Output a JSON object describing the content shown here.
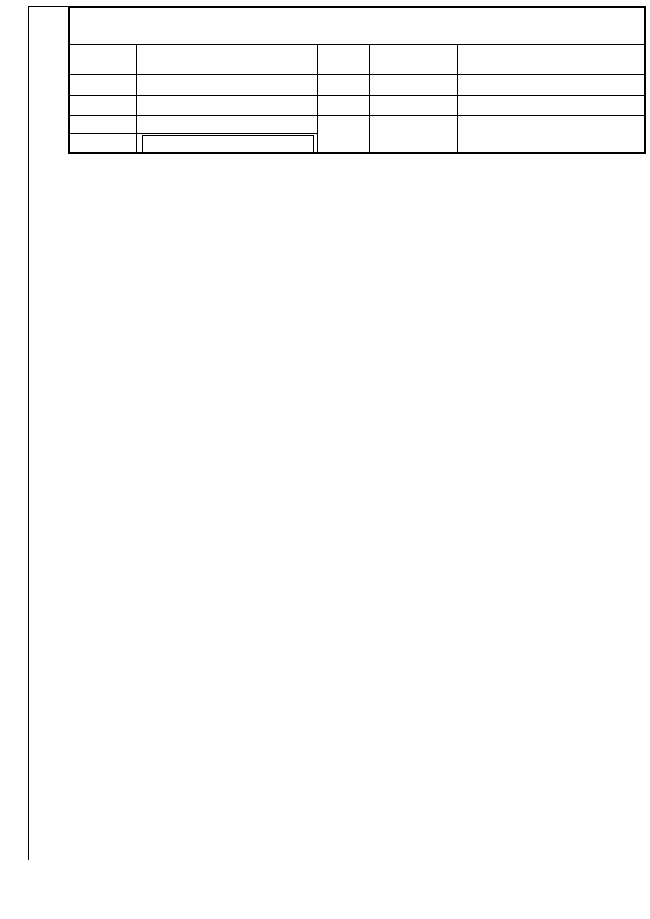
{
  "title_block": {
    "title": "GEODETSKI NAČRT",
    "rows": [
      {
        "label": "KATASTRSKA OBČINA",
        "value": "1246 - DEKMANCA"
      },
      {
        "label": "ŠT.VLOGE",
        "value": "27ŠM08"
      },
      {
        "label": "MERILO",
        "value": "1 : 500"
      },
      {
        "label": "PARCELA",
        "value": "280/3, *41"
      },
      {
        "label": "OPOMBA",
        "value": ""
      }
    ],
    "opomba_lines": [
      "PARCELNE MEJE: VIR/KAT.NAČRT 1:2880",
      "GK KOORD.SISTEM, VIŠINE SO ABSOLUTNE"
    ],
    "right": {
      "header_date": "Dne",
      "header_name": "Ime in priimek",
      "rows": [
        {
          "role": "Naročnik",
          "date": "22.6.2008",
          "name": "Vračun Ivan, Dekmanca 15"
        },
        {
          "role": "Meritve izvedel",
          "date": "7.7.2008",
          "name": "Matej Vračun dipl. inž.geod."
        },
        {
          "role": "Potrdil",
          "date": "4.8.2008",
          "name": "Matej Kovačič univ.dipl.inž.geod."
        }
      ]
    }
  },
  "frame": {
    "northings": [
      {
        "lines": [
          "104",
          "350"
        ],
        "y": 96
      },
      {
        "lines": [
          "104",
          "300"
        ],
        "y": 413
      },
      {
        "lines": [
          "104",
          "250"
        ],
        "y": 722
      },
      {
        "lines": [
          "104",
          "225"
        ],
        "y": 874
      }
    ],
    "eastings": [
      {
        "lines": [
          "548",
          "950"
        ],
        "x": 27
      },
      {
        "lines": [
          "549",
          "000"
        ],
        "x": 303
      },
      {
        "lines": [
          "549",
          "050"
        ],
        "x": 582
      }
    ],
    "credit": "Geodetski zavod Celje d.o.o.",
    "geos": "®GEOS 6"
  },
  "legend": {
    "title": "LEGENDA",
    "items": [
      {
        "sym": "drog",
        "label": "- Drog za električni vod nizke napetosti",
        "y": 671
      },
      {
        "sym": "jasek",
        "label": "- Kvadratni jašek",
        "y": 687
      },
      {
        "sym": "tel",
        "label": "- Telefonska omarica",
        "y": 700
      },
      {
        "sym": "stavba",
        "label": "- Stanovanjska stavba",
        "y": 712
      },
      {
        "sym": "gospodarsko",
        "label": "- Gospodarsko poslopje",
        "y": 726
      },
      {
        "sym": "vrt",
        "label": "- Vrt",
        "y": 739
      },
      {
        "sym": "travnik",
        "label": "- Travnik",
        "y": 751
      },
      {
        "sym": "znak",
        "label": "- znak pripadnosti",
        "y": 772
      },
      {
        "sym": "sevar",
        "label": "- Sevar",
        "y": 785
      },
      {
        "sym": "ograja",
        "label": "- Ograja",
        "y": 797
      },
      {
        "sym": "vodovod",
        "label": "- Vodovod",
        "y": 810
      },
      {
        "sym": "elvod",
        "label": "- El.vod N.N.",
        "y": 823
      },
      {
        "sym": "ptt",
        "label": "- PTT vod",
        "y": 836
      },
      {
        "sym": "meja",
        "label": "- Parcelna meja",
        "y": 855
      },
      {
        "sym": "stevilka",
        "label": "- Parcelna številka",
        "y": 884
      }
    ],
    "parcel_sample": "280/3"
  },
  "map": {
    "colors": {
      "parcel": "#ff00e6",
      "parcel_pale": "#ffa8ef",
      "contour": "#b06a28",
      "water": "#2233dd",
      "power": "#cc2211",
      "ptt": "#e08a00",
      "black": "#000000"
    },
    "parcel_labels": [
      {
        "t": "281/1",
        "x": 172,
        "y": 380
      },
      {
        "t": "281/2",
        "x": 375,
        "y": 395
      },
      {
        "t": "185",
        "x": 591,
        "y": 233
      },
      {
        "t": "280/1",
        "x": 589,
        "y": 337
      },
      {
        "t": "280/2",
        "x": 556,
        "y": 530
      },
      {
        "t": "280/3",
        "x": 283,
        "y": 582
      },
      {
        "t": "*41",
        "x": 321,
        "y": 509
      },
      {
        "t": "*42/1",
        "x": 219,
        "y": 581
      },
      {
        "t": "*42/2",
        "x": 141,
        "y": 730
      },
      {
        "t": "*42/3",
        "x": 286,
        "y": 659
      },
      {
        "t": "280/4",
        "x": 279,
        "y": 721
      },
      {
        "t": "1440",
        "x": 552,
        "y": 601
      },
      {
        "t": "1443",
        "x": 422,
        "y": 667
      }
    ],
    "contour_labels": [
      {
        "t": "210",
        "x": 506,
        "y": 222,
        "rot": -38
      },
      {
        "t": "209",
        "x": 441,
        "y": 343,
        "rot": -50
      },
      {
        "t": "215",
        "x": 237,
        "y": 414,
        "rot": -18
      }
    ],
    "spot_heights": [
      {
        "x": 333,
        "y": 204,
        "v": "208.86"
      },
      {
        "x": 321,
        "y": 212,
        "v": "208.88"
      },
      {
        "x": 404,
        "y": 195,
        "v": "205.95"
      },
      {
        "x": 414,
        "y": 255,
        "v": "206.37"
      },
      {
        "x": 309,
        "y": 241,
        "v": "211.15"
      },
      {
        "x": 604,
        "y": 247,
        "v": "203.96"
      },
      {
        "x": 634,
        "y": 271,
        "v": "204.42"
      },
      {
        "x": 552,
        "y": 289,
        "v": "205.05"
      },
      {
        "x": 616,
        "y": 339,
        "v": "205.93"
      },
      {
        "x": 587,
        "y": 372,
        "v": "206.79"
      },
      {
        "x": 540,
        "y": 409,
        "v": "211.48"
      },
      {
        "x": 437,
        "y": 318,
        "v": "205.20"
      },
      {
        "x": 196,
        "y": 293,
        "v": "212.22"
      },
      {
        "x": 341,
        "y": 305,
        "v": "211.81"
      },
      {
        "x": 351,
        "y": 336,
        "v": "212.71"
      },
      {
        "x": 256,
        "y": 370,
        "v": "212.72"
      },
      {
        "x": 270,
        "y": 374,
        "v": "212.27"
      },
      {
        "x": 313,
        "y": 384,
        "v": "214.58"
      },
      {
        "x": 232,
        "y": 400,
        "v": "216.20"
      },
      {
        "x": 98,
        "y": 359,
        "v": "212.93"
      },
      {
        "x": 497,
        "y": 345,
        "v": "209.28"
      },
      {
        "x": 452,
        "y": 380,
        "v": "211.02"
      },
      {
        "x": 500,
        "y": 392,
        "v": "211.99"
      },
      {
        "x": 223,
        "y": 425,
        "v": "215.12"
      },
      {
        "x": 233,
        "y": 438,
        "v": "215.75"
      },
      {
        "x": 272,
        "y": 440,
        "v": "215.77"
      },
      {
        "x": 330,
        "y": 425,
        "v": "215.13"
      },
      {
        "x": 327,
        "y": 442,
        "v": "215.43"
      },
      {
        "x": 345,
        "y": 462,
        "v": "216.75"
      },
      {
        "x": 273,
        "y": 477,
        "v": "216.18"
      },
      {
        "x": 255,
        "y": 498,
        "v": "215.80"
      },
      {
        "x": 265,
        "y": 515,
        "v": "215.90"
      },
      {
        "x": 193,
        "y": 537,
        "v": "217.43"
      },
      {
        "x": 103,
        "y": 573,
        "v": "215.57"
      },
      {
        "x": 132,
        "y": 583,
        "v": "217.75"
      },
      {
        "x": 213,
        "y": 568,
        "v": "217.73"
      },
      {
        "x": 243,
        "y": 592,
        "v": "217.14"
      },
      {
        "x": 175,
        "y": 605,
        "v": "217.80"
      },
      {
        "x": 203,
        "y": 628,
        "v": "217.82"
      },
      {
        "x": 153,
        "y": 622,
        "v": "218.00"
      },
      {
        "x": 173,
        "y": 652,
        "v": "215.24"
      },
      {
        "x": 168,
        "y": 672,
        "v": "215.20"
      },
      {
        "x": 263,
        "y": 608,
        "v": "215.83"
      },
      {
        "x": 290,
        "y": 638,
        "v": "215.87"
      },
      {
        "x": 317,
        "y": 658,
        "v": "215.90"
      },
      {
        "x": 352,
        "y": 535,
        "v": "216.43"
      },
      {
        "x": 325,
        "y": 560,
        "v": "215.42"
      },
      {
        "x": 307,
        "y": 568,
        "v": "216.88"
      },
      {
        "x": 317,
        "y": 592,
        "v": "215.24"
      },
      {
        "x": 312,
        "y": 597,
        "v": "215.22"
      },
      {
        "x": 323,
        "y": 598,
        "v": "215.47"
      },
      {
        "x": 138,
        "y": 455,
        "v": "214.59"
      },
      {
        "x": 425,
        "y": 412,
        "v": "212.82"
      },
      {
        "x": 402,
        "y": 442,
        "v": "216.44"
      },
      {
        "x": 442,
        "y": 445,
        "v": "214.89"
      },
      {
        "x": 475,
        "y": 442,
        "v": "211.98"
      },
      {
        "x": 522,
        "y": 423,
        "v": "213.04"
      },
      {
        "x": 478,
        "y": 468,
        "v": "211.95"
      },
      {
        "x": 430,
        "y": 462,
        "v": "214.08"
      },
      {
        "x": 448,
        "y": 475,
        "v": "211.25"
      },
      {
        "x": 390,
        "y": 470,
        "v": "214.13"
      },
      {
        "x": 430,
        "y": 488,
        "v": "213.82"
      },
      {
        "x": 415,
        "y": 498,
        "v": "211.39"
      },
      {
        "x": 462,
        "y": 503,
        "v": "211.27"
      },
      {
        "x": 422,
        "y": 515,
        "v": "212.12"
      },
      {
        "x": 448,
        "y": 532,
        "v": "210.85"
      },
      {
        "x": 455,
        "y": 542,
        "v": "210.83"
      },
      {
        "x": 455,
        "y": 552,
        "v": "210.87"
      },
      {
        "x": 432,
        "y": 560,
        "v": "211.07"
      },
      {
        "x": 437,
        "y": 573,
        "v": "212.97"
      },
      {
        "x": 440,
        "y": 587,
        "v": "213.25"
      },
      {
        "x": 470,
        "y": 572,
        "v": "210.41"
      },
      {
        "x": 520,
        "y": 528,
        "v": "211.82"
      },
      {
        "x": 503,
        "y": 540,
        "v": "208.98"
      },
      {
        "x": 502,
        "y": 546,
        "v": "208.09"
      },
      {
        "x": 388,
        "y": 532,
        "v": "213.21"
      },
      {
        "x": 418,
        "y": 532,
        "v": "212.21"
      },
      {
        "x": 417,
        "y": 553,
        "v": "213.75"
      },
      {
        "x": 382,
        "y": 552,
        "v": "214.28"
      },
      {
        "x": 400,
        "y": 552,
        "v": "214.28"
      },
      {
        "x": 405,
        "y": 605,
        "v": "213.24"
      },
      {
        "x": 273,
        "y": 681,
        "v": "217.21"
      },
      {
        "x": 317,
        "y": 662,
        "v": "215.80"
      }
    ],
    "grass": [
      {
        "x": 253,
        "y": 316
      },
      {
        "x": 240,
        "y": 330
      },
      {
        "x": 266,
        "y": 330
      },
      {
        "x": 503,
        "y": 303
      },
      {
        "x": 516,
        "y": 292
      },
      {
        "x": 528,
        "y": 304
      },
      {
        "x": 638,
        "y": 368
      },
      {
        "x": 627,
        "y": 382
      },
      {
        "x": 192,
        "y": 493
      },
      {
        "x": 179,
        "y": 505
      },
      {
        "x": 204,
        "y": 505
      },
      {
        "x": 112,
        "y": 688
      },
      {
        "x": 100,
        "y": 700
      },
      {
        "x": 124,
        "y": 700
      }
    ],
    "crosses": [
      {
        "x": 303,
        "y": 425
      },
      {
        "x": 613,
        "y": 425
      },
      {
        "x": 303,
        "y": 736
      },
      {
        "x": 613,
        "y": 736
      }
    ],
    "point_symbols": [
      {
        "type": "drog",
        "x": 485,
        "y": 341
      },
      {
        "type": "tel",
        "x": 284,
        "y": 492
      },
      {
        "type": "jasek",
        "x": 274,
        "y": 508
      },
      {
        "type": "vrt",
        "x": 374,
        "y": 596
      },
      {
        "type": "vrt",
        "x": 188,
        "y": 545
      },
      {
        "type": "sevar-big",
        "x": 92,
        "y": 618
      }
    ]
  }
}
